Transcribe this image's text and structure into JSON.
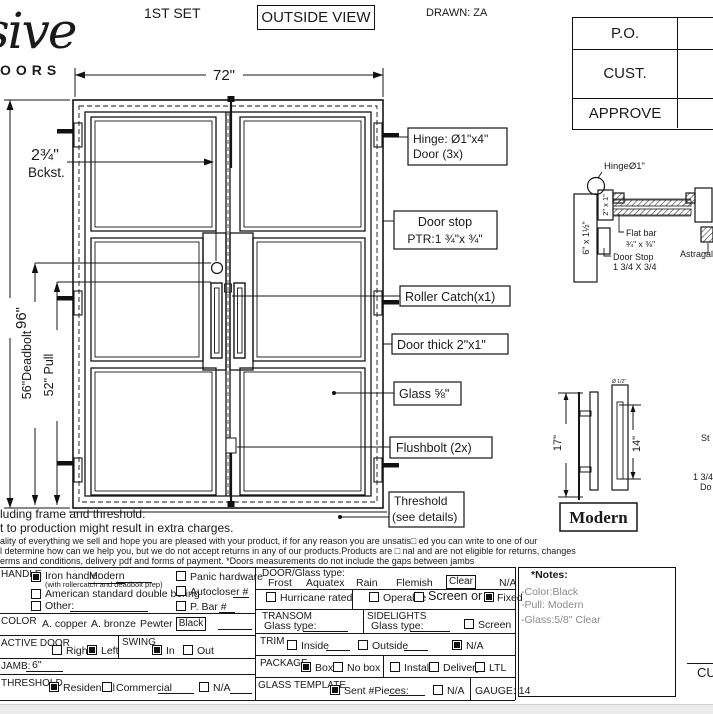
{
  "header": {
    "set_label": "1ST SET",
    "view_label": "OUTSIDE VIEW",
    "drawn_label": "DRAWN: ZA",
    "title_block": {
      "row1": "P.O.",
      "row2": "CUST.",
      "row3": "APPROVE"
    }
  },
  "logo": {
    "script": "sive",
    "sub": "OORS"
  },
  "elevation": {
    "dims": {
      "width": "72\"",
      "height": "96\"",
      "deadbolt": "56\"Deadbolt",
      "pull": "52\" Pull",
      "backset_value": "2¾\"",
      "backset_label": "Bckst."
    },
    "callouts": {
      "hinge_line1": "Hinge: Ø1\"x4\"",
      "hinge_line2": "Door (3x)",
      "door_stop_line1": "Door stop",
      "door_stop_line2": "PTR:1 ¾\"x ¾\"",
      "roller_catch": "Roller Catch(x1)",
      "door_thick": "Door thick 2\"x1\"",
      "glass": "Glass ⅝\"",
      "flushbolt": "Flushbolt (2x)",
      "threshold_line1": "Threshold",
      "threshold_line2": "(see details)"
    }
  },
  "section_detail": {
    "hinge": "HingeØ1\"",
    "tube": "2\" x 1\"",
    "jamb": "6\" x 1½\"",
    "flat_bar_line1": "Flat bar",
    "flat_bar_line2": "¾\" x ⅜\"",
    "door_stop_line1": "Door Stop",
    "door_stop_line2": "1 3/4 X 3/4",
    "astragal": "Astragal"
  },
  "handle_detail": {
    "height": "17\"",
    "spacing": "14\"",
    "diameter": "Ø 1/2\"",
    "name": "Modern"
  },
  "edge_fragments": {
    "f1": "St",
    "f2": "1 3/4",
    "f3": "Do",
    "f4": "CU"
  },
  "disclaimer": {
    "line1": "luding frame and threshold.",
    "line2": "t to production might result in extra charges.",
    "line3": "ality of everything we sell and hope you are pleased with your product, if for any reason you are unsatis□ ed you can write to one of our",
    "line4": "l determine how can we help you, but we do not accept returns in any of our products.Products are □ nal and are not eligible for returns, changes",
    "line5": "erms and conditions, delivery pdf and forms of payment. *Doors measurements do not include the gaps between jambs"
  },
  "form": {
    "handle": {
      "label": "HANDLE",
      "iron_label": "Iron handle:",
      "iron_value": "Modern",
      "iron_note": "(with rollercatch and deadbolt prep)",
      "american": "American standard double boring",
      "other": "Other:",
      "panic": "Panic hardware",
      "autocloser": "Autocloser #",
      "pbar": "P. Bar #"
    },
    "color": {
      "label": "COLOR",
      "opt1": "A. copper",
      "opt2": "A. bronze",
      "opt3": "Pewter",
      "selected": "Black"
    },
    "active_door": {
      "label": "ACTIVE DOOR",
      "right": "Right",
      "left": "Left"
    },
    "swing": {
      "label": "SWING",
      "in": "In",
      "out": "Out"
    },
    "jamb": {
      "label": "JAMB:",
      "value": "6\""
    },
    "threshold": {
      "label": "THRESHOLD",
      "residential": "Residential",
      "commercial": "Commercial",
      "na": "N/A"
    },
    "glass": {
      "label": "DOOR/Glass type:",
      "opt1": "Frost",
      "opt2": "Aquatex",
      "opt3": "Rain",
      "opt4": "Flemish",
      "selected": "Clear",
      "na": "N/A",
      "hurricane": "Hurricane rated",
      "operable": "Operable",
      "screen_or": "Screen or",
      "fixed": "Fixed"
    },
    "transom": {
      "label": "TRANSOM",
      "glass_type": "Glass type:"
    },
    "sidelights": {
      "label": "SIDELIGHTS",
      "glass_type": "Glass type:",
      "screen": "Screen"
    },
    "trim": {
      "label": "TRIM",
      "inside": "Inside",
      "outside": "Outside",
      "na": "N/A"
    },
    "package": {
      "label": "PACKAGE",
      "box": "Box",
      "no_box": "No box",
      "install": "Install",
      "delivery": "Delivery",
      "ltl": "LTL"
    },
    "glass_template": {
      "label": "GLASS TEMPLATE",
      "sent": "Sent #Pieces:",
      "na": "N/A",
      "gauge": "GAUGE: 14"
    }
  },
  "checks": {
    "iron_handle": true,
    "american": false,
    "other": false,
    "panic": false,
    "autocloser": false,
    "pbar": false,
    "right": false,
    "left": true,
    "swing_in": true,
    "swing_out": false,
    "residential": true,
    "commercial": false,
    "threshold_na": false,
    "hurricane": false,
    "operable": false,
    "screen_or": false,
    "fixed": true,
    "sidelights_screen": false,
    "trim_inside": false,
    "trim_outside": false,
    "trim_na": true,
    "pkg_box": true,
    "pkg_nobox": false,
    "pkg_install": false,
    "pkg_delivery": false,
    "pkg_ltl": false,
    "gt_sent": true,
    "gt_na": false
  },
  "notes": {
    "title": "*Notes:",
    "line1": "-Color:Black",
    "line2": "-Pull: Modern",
    "line3": "-Glass:5/8\" Clear"
  }
}
